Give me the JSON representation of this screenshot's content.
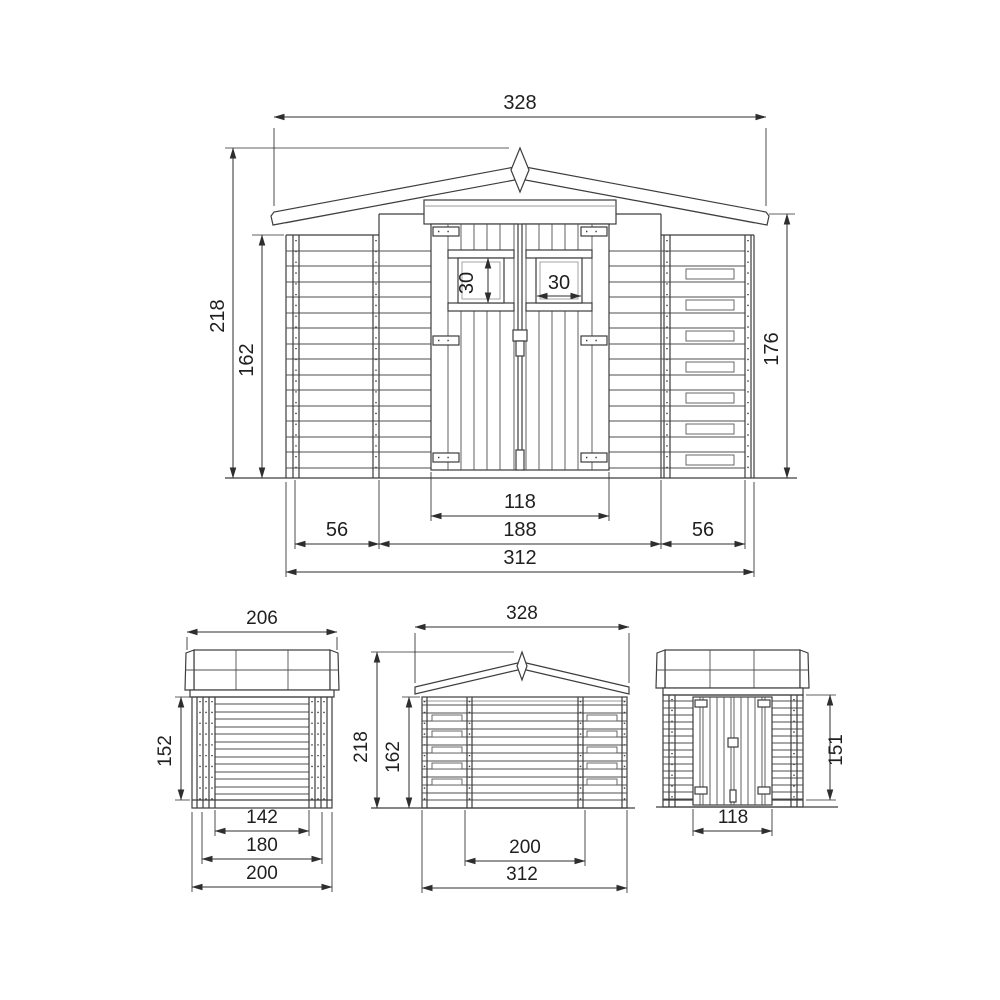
{
  "drawing": {
    "front_view": {
      "roof_width": "328",
      "total_height": "218",
      "wall_height": "162",
      "side_height": "176",
      "window_height": "30",
      "window_width": "30",
      "door_width": "118",
      "door_section_width": "188",
      "left_panel_width": "56",
      "right_panel_width": "56",
      "base_width": "312"
    },
    "side_view": {
      "roof_depth": "206",
      "wall_height": "152",
      "inner_depth": "142",
      "mid_depth": "180",
      "base_depth": "200"
    },
    "back_view": {
      "roof_width": "328",
      "total_height": "218",
      "wall_height": "162",
      "inner_width": "200",
      "base_width": "312"
    },
    "door_view": {
      "door_height": "151",
      "door_width": "118"
    },
    "colors": {
      "line": "#3d3d3d",
      "dimension": "#2e2e2e",
      "slat": "#4f4f4f",
      "background": "#ffffff"
    }
  }
}
